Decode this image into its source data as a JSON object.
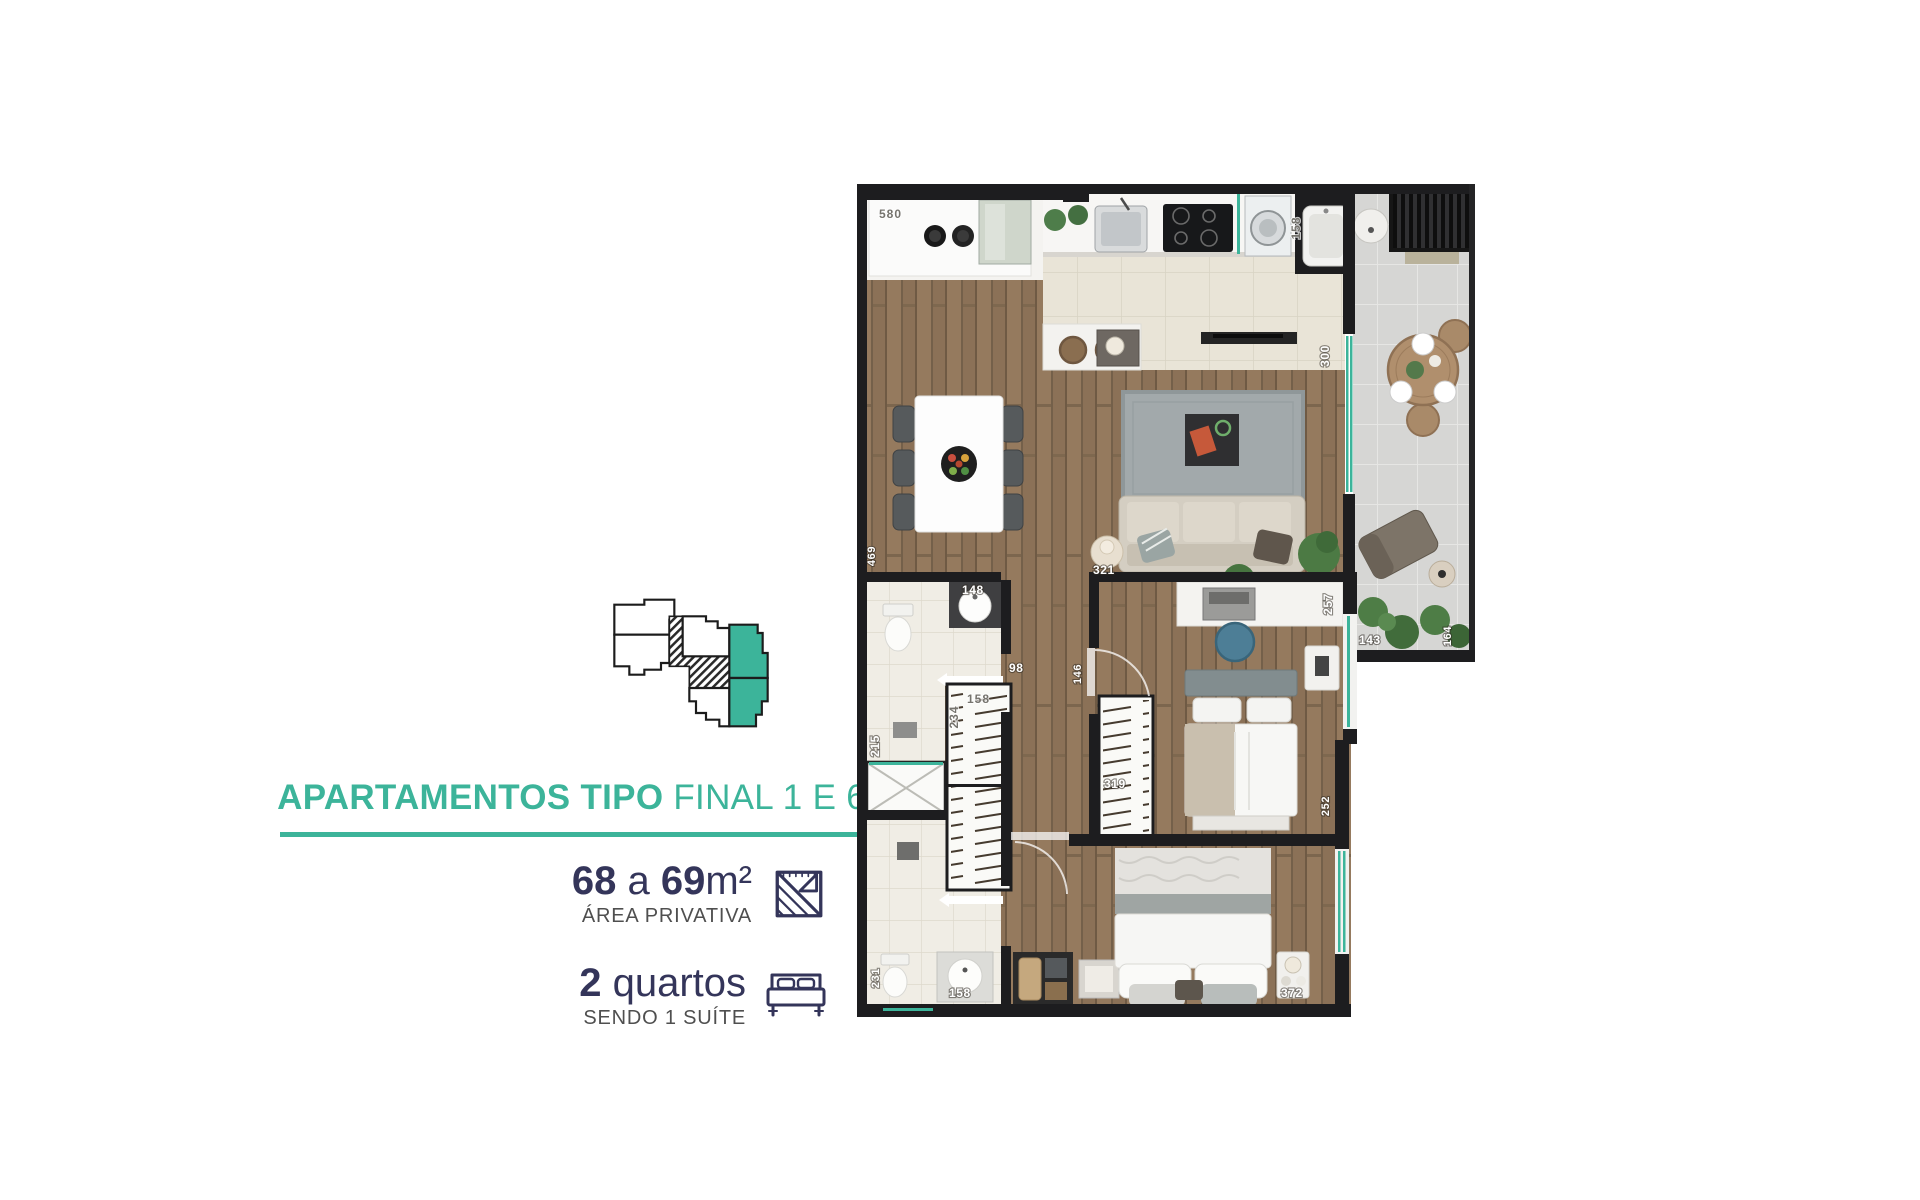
{
  "theme": {
    "accent": "#3cb49a",
    "navy": "#34355a",
    "gray_text": "#4f4f4f",
    "wall": "#1d1d1f",
    "page_bg": "#ffffff"
  },
  "panel": {
    "title_bold": "APARTAMENTOS TIPO",
    "title_regular": "FINAL 1 E 6",
    "area": {
      "num1": "68",
      "connector": "a",
      "num2": "69",
      "unit": "m²",
      "caption": "ÁREA PRIVATIVA"
    },
    "bedrooms": {
      "num": "2",
      "label": "quartos",
      "caption": "SENDO 1 SUÍTE"
    }
  },
  "keyplan": {
    "highlight_color": "#3cb49a",
    "outline_color": "#1c1c1c"
  },
  "floorplan": {
    "dims": {
      "laundry_counter": "580",
      "washer": "158",
      "balcony_door": "300",
      "bath1_sink": "148",
      "hall_door": "98",
      "shower1": "215",
      "closet_depth": "234",
      "closet_width": "158",
      "bed2_door": "146",
      "bed2_wardrobe": "319",
      "desk": "257",
      "bed2_window": "143",
      "balcony_end": "164",
      "living_width": "469",
      "side_table": "321",
      "shower2": "231",
      "bath2_sink": "158",
      "suite_window": "252",
      "suite_nightstand": "372"
    }
  }
}
